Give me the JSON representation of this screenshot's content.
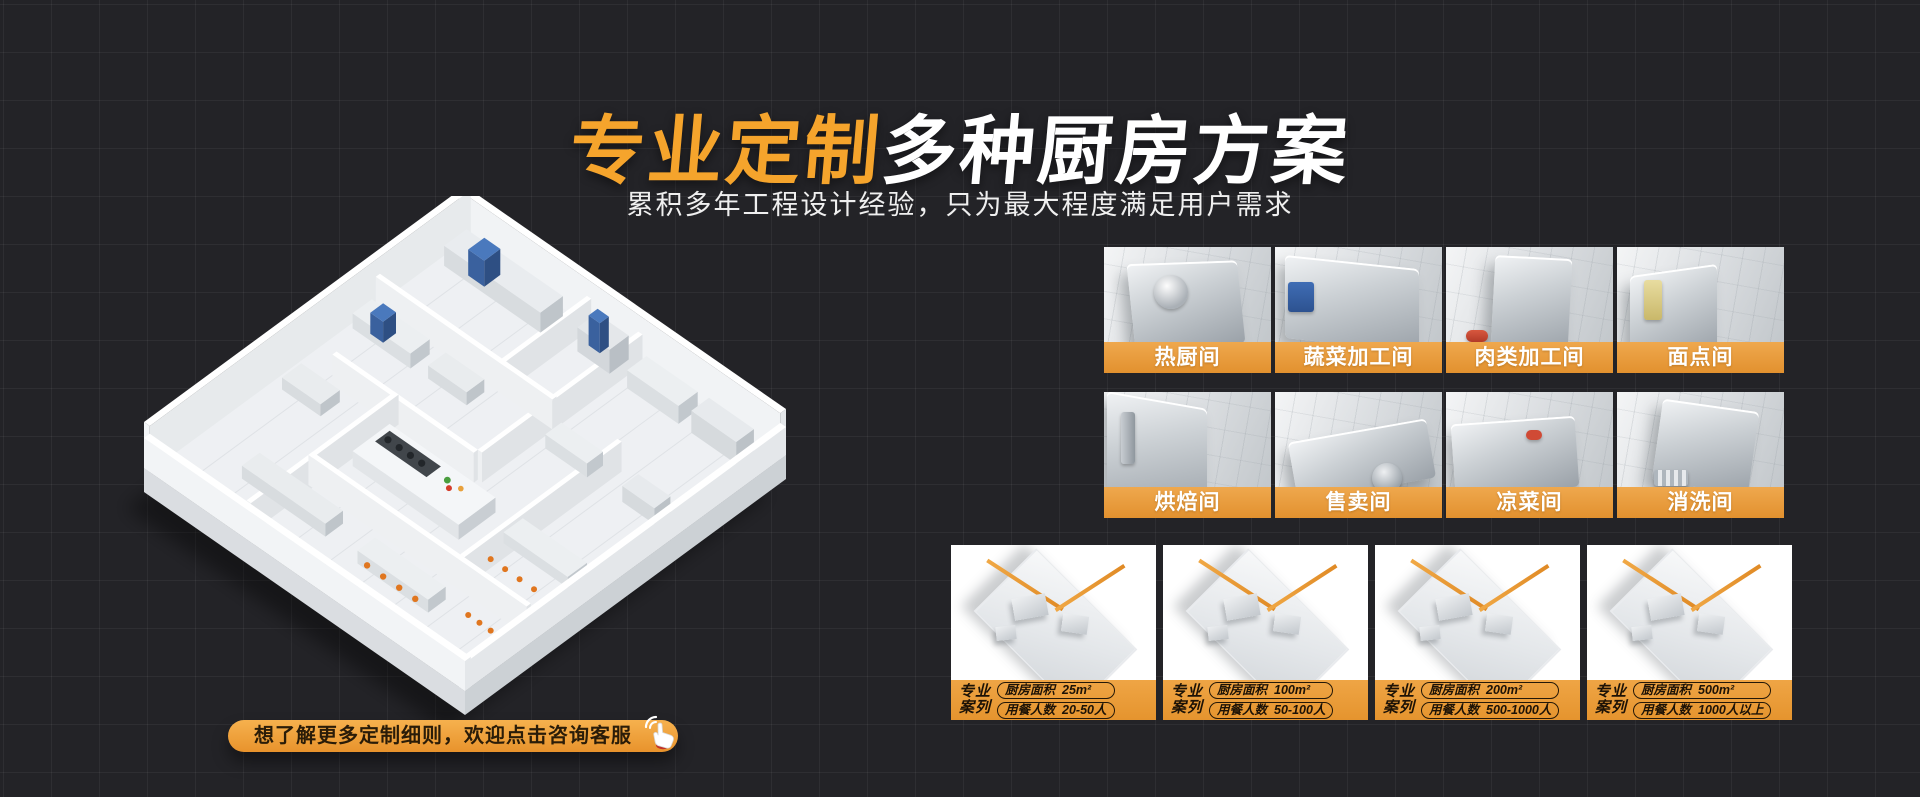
{
  "hero": {
    "title_highlight": "专业定制",
    "title_rest": "多种厨房方案",
    "subtitle": "累积多年工程设计经验，只为最大程度满足用户需求"
  },
  "rooms": [
    {
      "label": "热厨间"
    },
    {
      "label": "蔬菜加工间"
    },
    {
      "label": "肉类加工间"
    },
    {
      "label": "面点间"
    },
    {
      "label": "烘焙间"
    },
    {
      "label": "售卖间"
    },
    {
      "label": "凉菜间"
    },
    {
      "label": "消洗间"
    }
  ],
  "cases": {
    "badge_line1": "专业",
    "badge_line2": "案列",
    "area_label": "厨房面积",
    "diners_label": "用餐人数",
    "items": [
      {
        "area": "25m²",
        "diners": "20-50人"
      },
      {
        "area": "100m²",
        "diners": "50-100人"
      },
      {
        "area": "200m²",
        "diners": "500-1000人"
      },
      {
        "area": "500m²",
        "diners": "1000人以上"
      }
    ]
  },
  "cta": {
    "label": "想了解更多定制细则，欢迎点击咨询客服",
    "icon": "tap-hand-icon"
  },
  "colors": {
    "background": "#232327",
    "title_accent": "#F5A42C",
    "label_bar_orange": "#E89B3C",
    "cta_orange": "#F0A03C"
  }
}
